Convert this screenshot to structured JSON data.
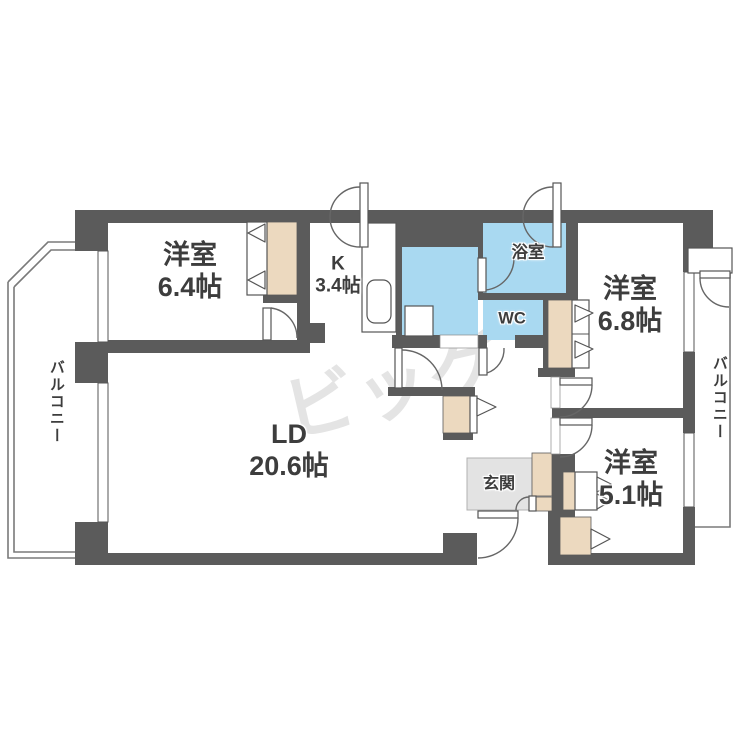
{
  "floorplan": {
    "watermark": "ビッグ",
    "rooms": {
      "bedroom1": {
        "name": "洋室",
        "size": "6.4帖"
      },
      "kitchen": {
        "name": "K",
        "size": "3.4帖"
      },
      "bath": {
        "name": "浴室"
      },
      "toilet": {
        "name": "WC"
      },
      "bedroom2": {
        "name": "洋室",
        "size": "6.8帖"
      },
      "living": {
        "name": "LD",
        "size": "20.6帖"
      },
      "entrance": {
        "name": "玄関"
      },
      "bedroom3": {
        "name": "洋室",
        "size": "5.1帖"
      },
      "balcony_left": {
        "name": "バルコニー"
      },
      "balcony_right": {
        "name": "バルコニー"
      }
    }
  },
  "colors": {
    "wall": "#5b5b5b",
    "water": "#a9d9f1",
    "closet": "#ecd9bf",
    "entrance_floor": "#e3e3e3",
    "balcony_line": "#7a7a7a",
    "watermark": "#e4e4e4"
  }
}
